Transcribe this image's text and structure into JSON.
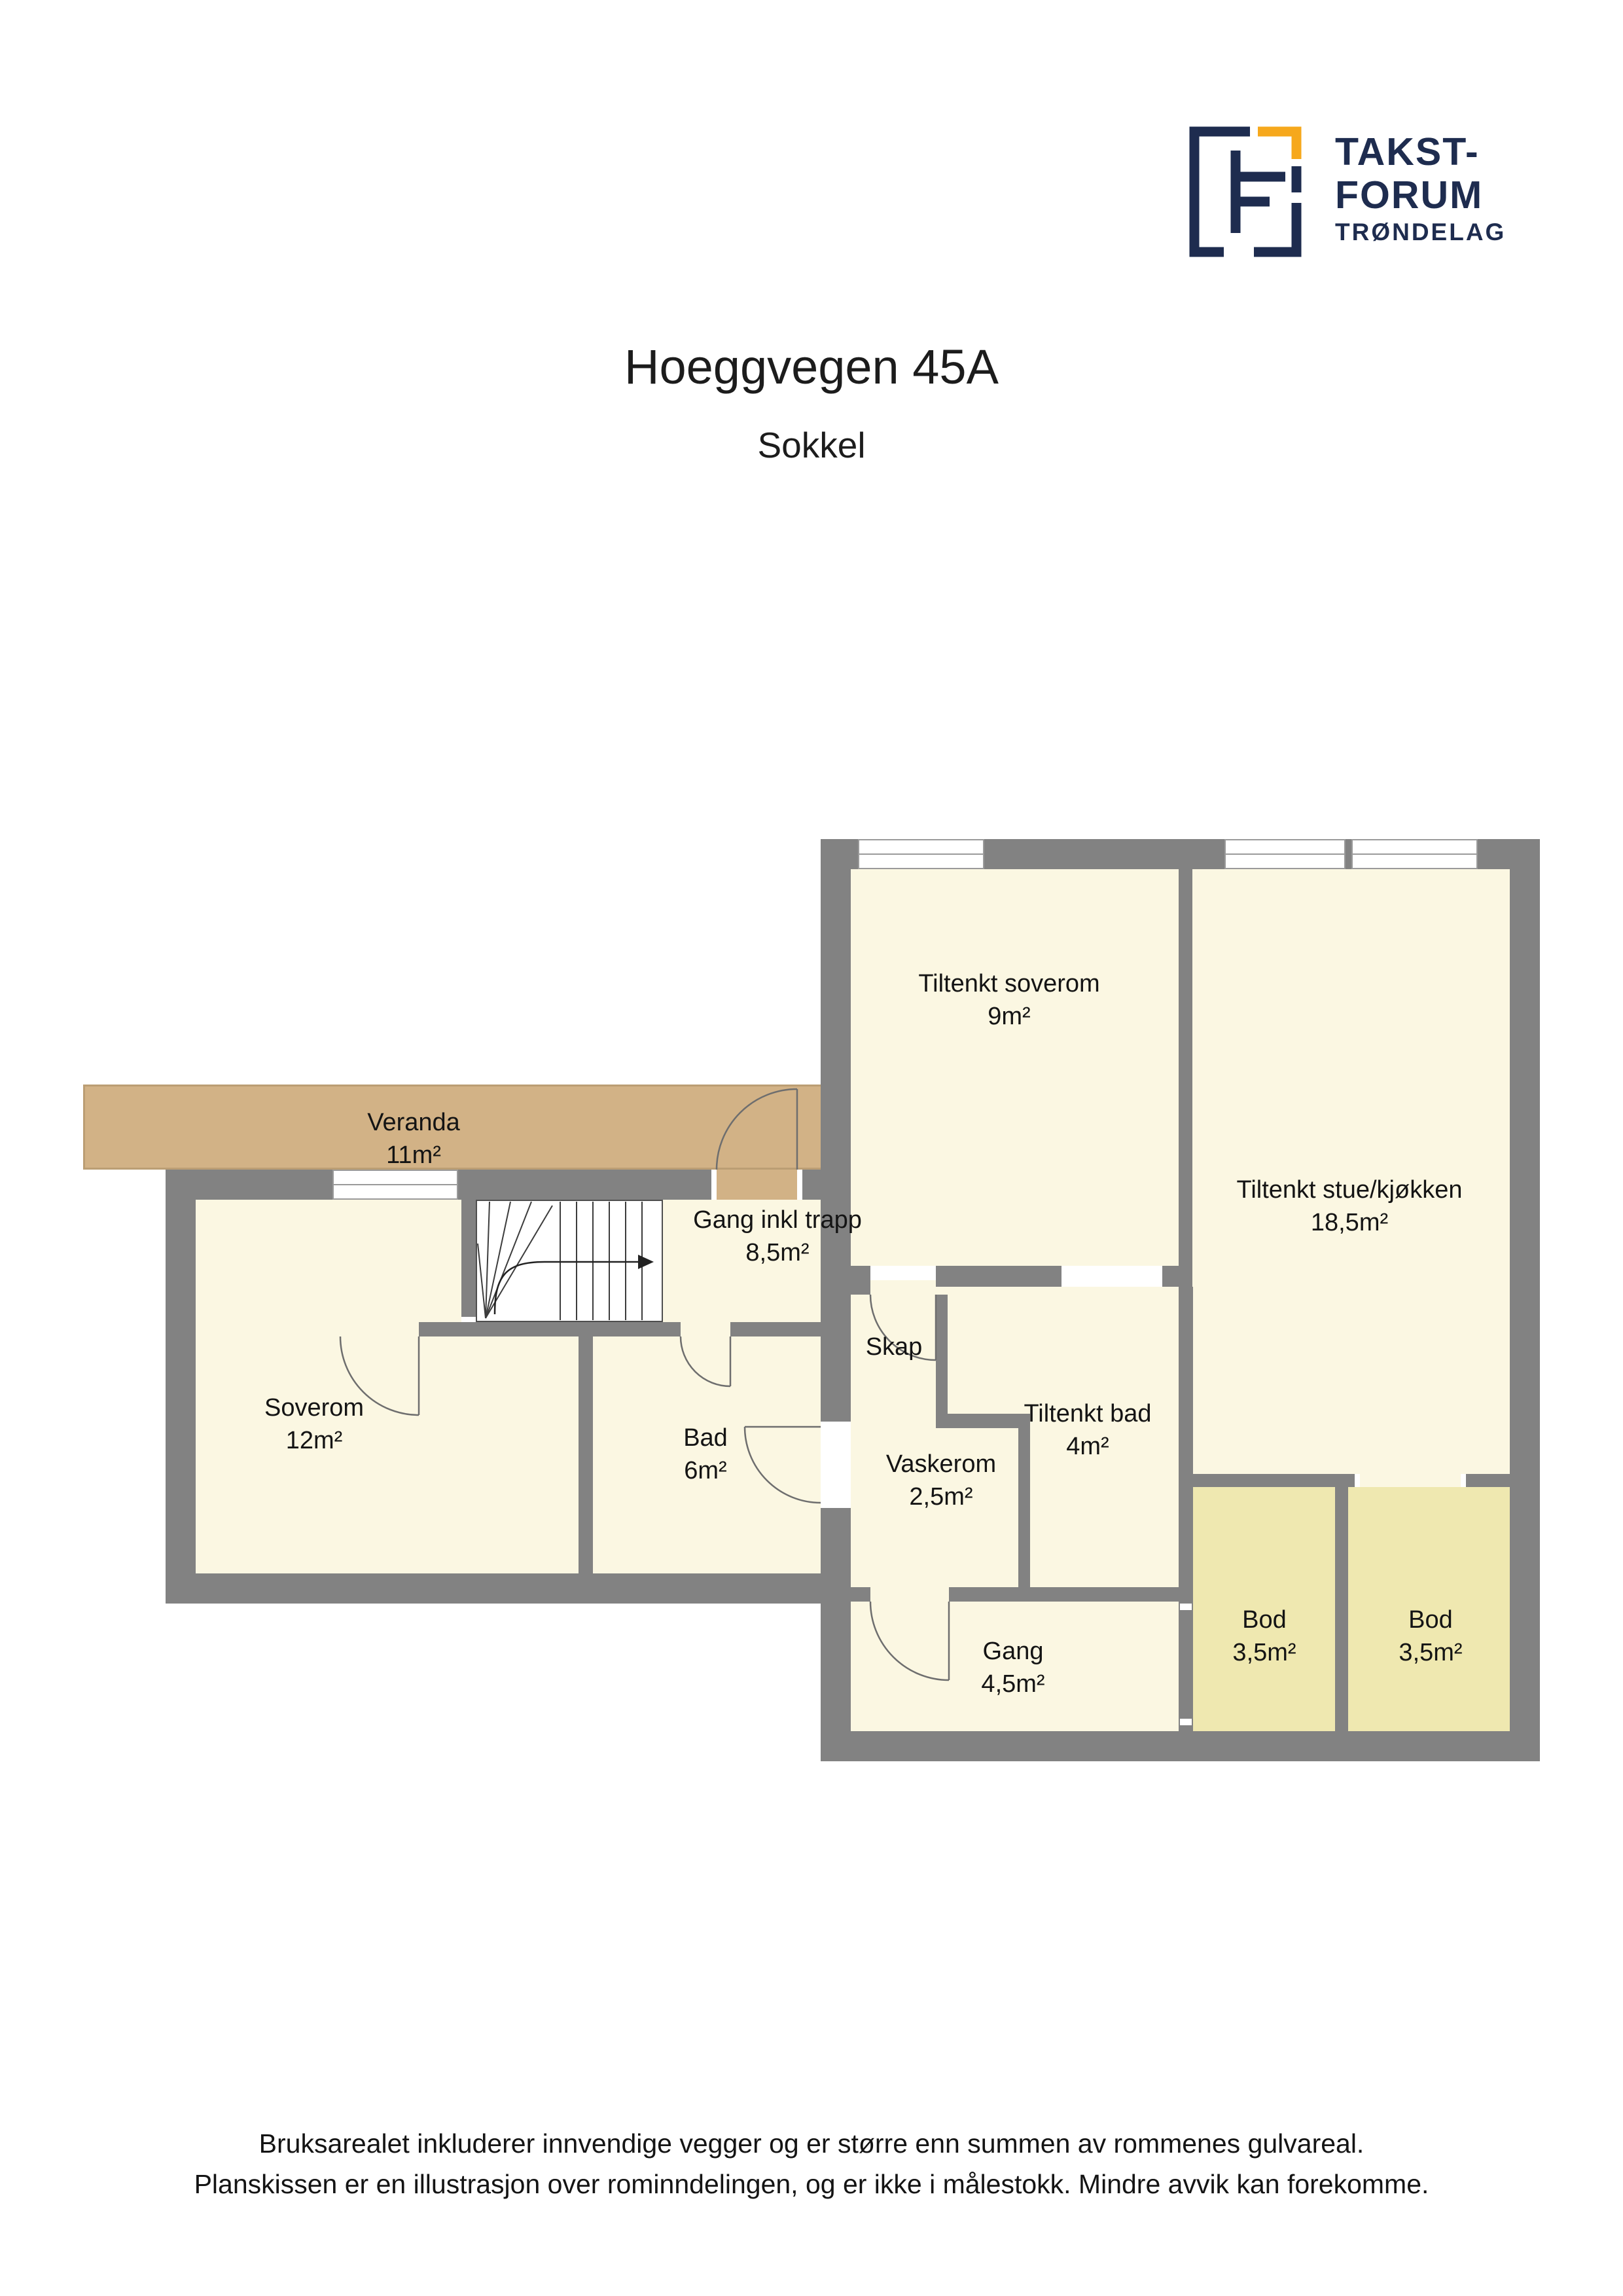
{
  "logo": {
    "line1": "TAKST-",
    "line2": "FORUM",
    "line3": "TRØNDELAG"
  },
  "header": {
    "title": "Hoeggvegen 45A",
    "subtitle": "Sokkel"
  },
  "rooms": {
    "veranda": {
      "name": "Veranda",
      "area": "11m²"
    },
    "tiltenkt_soverom": {
      "name": "Tiltenkt soverom",
      "area": "9m²"
    },
    "stue_kjokken": {
      "name": "Tiltenkt stue/kjøkken",
      "area": "18,5m²"
    },
    "gang_trapp": {
      "name": "Gang inkl trapp",
      "area": "8,5m²"
    },
    "soverom": {
      "name": "Soverom",
      "area": "12m²"
    },
    "bad": {
      "name": "Bad",
      "area": "6m²"
    },
    "skap": {
      "name": "Skap"
    },
    "vaskerom": {
      "name": "Vaskerom",
      "area": "2,5m²"
    },
    "tiltenkt_bad": {
      "name": "Tiltenkt bad",
      "area": "4m²"
    },
    "gang": {
      "name": "Gang",
      "area": "4,5m²"
    },
    "bod1": {
      "name": "Bod",
      "area": "3,5m²"
    },
    "bod2": {
      "name": "Bod",
      "area": "3,5m²"
    }
  },
  "footer": {
    "line1": "Bruksarealet inkluderer innvendige vegger og er større enn summen av rommenes gulvareal.",
    "line2": "Planskissen er en illustrasjon over rominndelingen, og er ikke i målestokk. Mindre avvik kan forekomme."
  },
  "colors": {
    "navy": "#1e2c4f",
    "orange": "#f6a81c",
    "wall": "#828282",
    "cream": "#fbf7e2",
    "bod": "#efe8b0",
    "veranda": "#d2b286"
  }
}
